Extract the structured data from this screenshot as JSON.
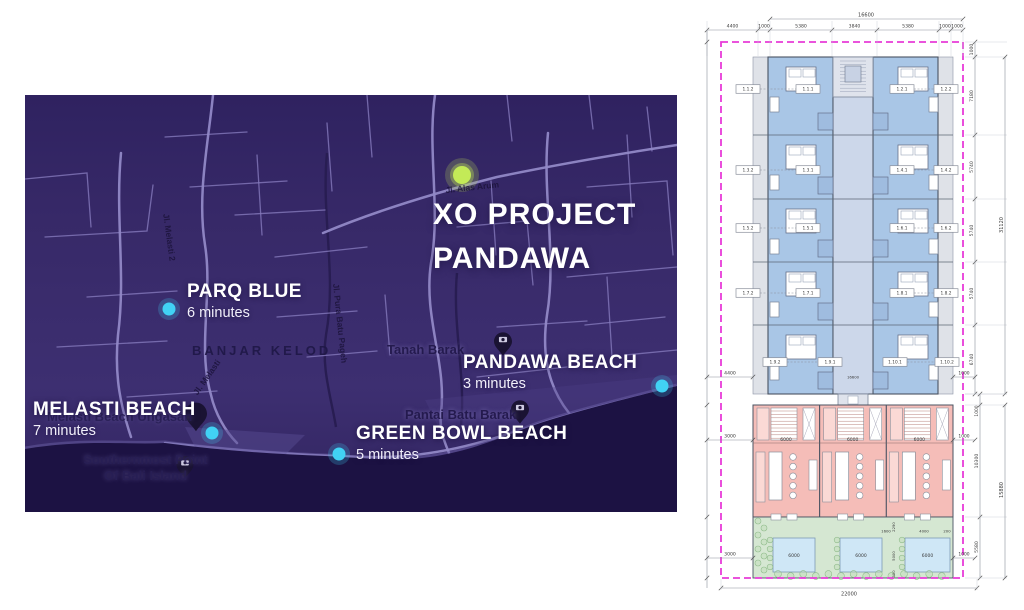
{
  "map": {
    "title_line1": "XO PROJECT",
    "title_line2": "PANDAWA",
    "markers": [
      {
        "id": "parq-blue",
        "name": "PARQ BLUE",
        "time": "6 minutes"
      },
      {
        "id": "melasti-beach",
        "name": "MELASTI BEACH",
        "time": "7 minutes"
      },
      {
        "id": "pandawa-beach",
        "name": "PANDAWA BEACH",
        "time": "3 minutes"
      },
      {
        "id": "green-bowl-beach",
        "name": "GREEN BOWL BEACH",
        "time": "5 minutes"
      }
    ],
    "place_labels": [
      {
        "id": "banjar-kelod",
        "text": "BANJAR KELOD"
      },
      {
        "id": "tanah-barak",
        "text": "Tanah Barak"
      },
      {
        "id": "pantai-batu-barak",
        "text": "Pantai Batu Barak"
      },
      {
        "id": "melasti-beach-ungasan",
        "text": "Melasti Beach Ungasan"
      },
      {
        "id": "southernmost-1",
        "text": "Southernmost Point"
      },
      {
        "id": "southernmost-2",
        "text": "Of Bali Island"
      }
    ],
    "road_labels": [
      {
        "id": "jl-alas-arum",
        "text": "Jl. Alas Arum"
      },
      {
        "id": "jl-pura-batu-pageh",
        "text": "Jl. Pura Batu Pageh"
      },
      {
        "id": "jl-melasti",
        "text": "Jl. Melasti"
      },
      {
        "id": "jl-melasti-2",
        "text": "Jl. Melasti 2"
      }
    ],
    "colors": {
      "background": "#38296a",
      "ocean": "#1c1243",
      "road": "#8579bc",
      "road_main": "#9188c6",
      "ravine": "#281d52",
      "marker_dot": "#41d2f4",
      "project_dot": "#c3ea57",
      "pin": "#1a1333",
      "label": "#ffffff"
    }
  },
  "plan": {
    "room_labels": [
      [
        "1.1.2",
        "1.1.1",
        "1.2.1",
        "1.2.2"
      ],
      [
        "1.3.2",
        "1.3.1",
        "1.4.1",
        "1.4.2"
      ],
      [
        "1.5.2",
        "1.5.1",
        "1.6.1",
        "1.6.2"
      ],
      [
        "1.7.2",
        "1.7.1",
        "1.8.1",
        "1.8.2"
      ],
      [
        "1.9.2",
        "1.9.1",
        "1.10.1",
        "1.10.2"
      ]
    ],
    "dims": {
      "top_total": "16600",
      "top_chain": [
        "4400",
        "1000",
        "5380",
        "3840",
        "5380",
        "1000",
        "1000"
      ],
      "right_rows": [
        "1000",
        "7180",
        "5740",
        "5740",
        "5740",
        "6740"
      ],
      "right_total": "31120",
      "right_lower": [
        "1000",
        "10300",
        "5580"
      ],
      "right_lower_total": "15880",
      "left_side": [
        "4400",
        "3000",
        "3000"
      ],
      "right_side_small": [
        "1000",
        "1000",
        "1000"
      ],
      "bottom_total": "22000",
      "corridor": "16600",
      "unit_width": "6000",
      "pool_width": "6000",
      "garden_small": [
        "2290",
        "1600",
        "4000",
        "200",
        "5000",
        "300"
      ]
    },
    "colors": {
      "room": "#a9c6e6",
      "bath": "#9fbcdf",
      "corridor": "#ccd7ea",
      "strip": "#dfe2e8",
      "unit": "#f5bdb8",
      "unit_light": "#fbd9d5",
      "garden": "#d5e7d2",
      "pool": "#cfe7f6",
      "boundary": "#e83bd8",
      "wall": "#4a5362",
      "dim": "#3a3a3a"
    }
  }
}
